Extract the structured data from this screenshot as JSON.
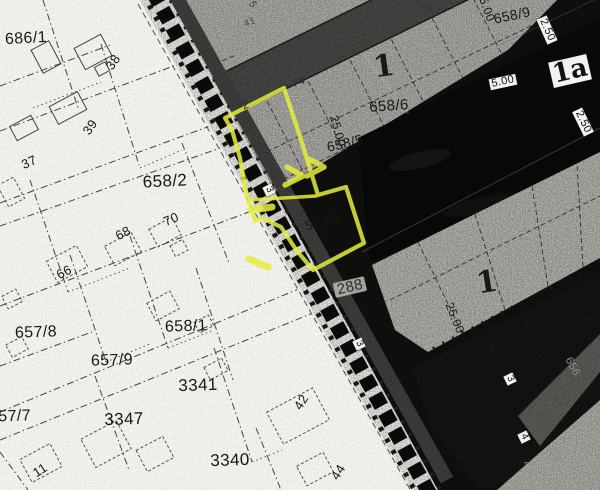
{
  "map": {
    "highlight_color": "#e6ed3a",
    "labels": [
      {
        "id": "parcel-686-1",
        "text": "686/1",
        "x": 26,
        "y": 39,
        "rot": -3,
        "size": 16
      },
      {
        "id": "house-38",
        "text": "38",
        "x": 113,
        "y": 62,
        "rot": -55,
        "size": 13
      },
      {
        "id": "house-39",
        "text": "39",
        "x": 90,
        "y": 127,
        "rot": -55,
        "size": 13
      },
      {
        "id": "house-37",
        "text": "37",
        "x": 29,
        "y": 162,
        "rot": -24,
        "size": 13
      },
      {
        "id": "parcel-658-2",
        "text": "658/2",
        "x": 165,
        "y": 181,
        "rot": -3,
        "size": 17
      },
      {
        "id": "house-70",
        "text": "70",
        "x": 171,
        "y": 219,
        "rot": -24,
        "size": 13
      },
      {
        "id": "house-68",
        "text": "68",
        "x": 123,
        "y": 233,
        "rot": -28,
        "size": 13
      },
      {
        "id": "house-66",
        "text": "66",
        "x": 64,
        "y": 272,
        "rot": -28,
        "size": 13
      },
      {
        "id": "parcel-657-8",
        "text": "657/8",
        "x": 36,
        "y": 333,
        "rot": -2,
        "size": 16
      },
      {
        "id": "parcel-658-1",
        "text": "658/1",
        "x": 186,
        "y": 327,
        "rot": -2,
        "size": 16
      },
      {
        "id": "parcel-657-9",
        "text": "657/9",
        "x": 112,
        "y": 361,
        "rot": -2,
        "size": 16
      },
      {
        "id": "parcel-3341",
        "text": "3341",
        "x": 198,
        "y": 385,
        "rot": -2,
        "size": 17
      },
      {
        "id": "parcel-657-7",
        "text": "657/7",
        "x": 10,
        "y": 417,
        "rot": -2,
        "size": 16
      },
      {
        "id": "parcel-3347",
        "text": "3347",
        "x": 124,
        "y": 419,
        "rot": -2,
        "size": 17
      },
      {
        "id": "house-42",
        "text": "42",
        "x": 301,
        "y": 402,
        "rot": -58,
        "size": 13
      },
      {
        "id": "parcel-3340",
        "text": "3340",
        "x": 230,
        "y": 460,
        "rot": -2,
        "size": 17
      },
      {
        "id": "house-44",
        "text": "44",
        "x": 338,
        "y": 472,
        "rot": -58,
        "size": 13
      },
      {
        "id": "house-11",
        "text": "11",
        "x": 40,
        "y": 470,
        "rot": -33,
        "size": 13
      },
      {
        "id": "block-1-upper",
        "text": "1",
        "x": 384,
        "y": 67,
        "rot": -8,
        "size": 30,
        "cls": "big"
      },
      {
        "id": "parcel-658-6",
        "text": "658/6",
        "x": 389,
        "y": 106,
        "rot": -4,
        "size": 15
      },
      {
        "id": "dim-25-00-upper",
        "text": "25.00",
        "x": 338,
        "y": 131,
        "rot": 74,
        "size": 12
      },
      {
        "id": "parcel-658-5",
        "text": "658/5",
        "x": 345,
        "y": 143,
        "rot": -13,
        "size": 14
      },
      {
        "id": "parcel-658-9",
        "text": "658/9",
        "x": 512,
        "y": 15,
        "rot": -12,
        "size": 14
      },
      {
        "id": "dim-25-00-top",
        "text": "25.00",
        "x": 486,
        "y": 6,
        "rot": 70,
        "size": 12
      },
      {
        "id": "house-78",
        "text": "78",
        "x": 427,
        "y": 9,
        "rot": -24,
        "size": 11,
        "color": "#333330"
      },
      {
        "id": "dim-2-50-a",
        "text": "2.50",
        "x": 547,
        "y": 30,
        "rot": 66,
        "size": 11,
        "cls": "box"
      },
      {
        "id": "block-1a",
        "text": "1a",
        "x": 570,
        "y": 71,
        "rot": -13,
        "size": 26,
        "cls": "big box"
      },
      {
        "id": "dim-5-00",
        "text": "5.00",
        "x": 503,
        "y": 82,
        "rot": -12,
        "size": 11,
        "cls": "box"
      },
      {
        "id": "dim-2-50-b",
        "text": "2.50",
        "x": 583,
        "y": 122,
        "rot": 64,
        "size": 11,
        "cls": "box"
      },
      {
        "id": "dim-52-50",
        "text": "52.50",
        "x": 322,
        "y": 222,
        "rot": -14,
        "size": 13
      },
      {
        "id": "mark-plus",
        "text": "+",
        "x": 326,
        "y": 234,
        "rot": 0,
        "size": 10
      },
      {
        "id": "parcel-288",
        "text": "288",
        "x": 350,
        "y": 287,
        "rot": -13,
        "size": 15,
        "cls": "smudge"
      },
      {
        "id": "block-1-lower",
        "text": "1",
        "x": 487,
        "y": 283,
        "rot": -9,
        "size": 30,
        "cls": "big"
      },
      {
        "id": "dim-25-00-lower",
        "text": "25.00",
        "x": 455,
        "y": 318,
        "rot": 68,
        "size": 12
      },
      {
        "id": "tick-5",
        "text": "5",
        "x": 527,
        "y": 322,
        "rot": -20,
        "size": 11
      },
      {
        "id": "tick-3",
        "text": "3",
        "x": 492,
        "y": 348,
        "rot": -22,
        "size": 10,
        "color": "#222220"
      },
      {
        "id": "marker-3-rail-upper",
        "text": "3",
        "x": 269,
        "y": 190,
        "rot": 64,
        "size": 10,
        "cls": "box"
      },
      {
        "id": "marker-3-rail-mid",
        "text": "3",
        "x": 359,
        "y": 344,
        "rot": 64,
        "size": 10,
        "cls": "box"
      },
      {
        "id": "marker-3-east",
        "text": "3",
        "x": 510,
        "y": 379,
        "rot": 64,
        "size": 10,
        "cls": "box"
      },
      {
        "id": "marker-4",
        "text": "4",
        "x": 524,
        "y": 437,
        "rot": 64,
        "size": 10,
        "cls": "box"
      },
      {
        "id": "ghost-656",
        "text": "656",
        "x": 572,
        "y": 367,
        "rot": 62,
        "size": 11,
        "color": "#8f8f8c"
      },
      {
        "id": "ghost-320",
        "text": "320",
        "x": 555,
        "y": 455,
        "rot": 62,
        "size": 10,
        "color": "#8a8a86"
      },
      {
        "id": "ghost-458",
        "text": "458",
        "x": 529,
        "y": 470,
        "rot": 62,
        "size": 10,
        "color": "#979792"
      },
      {
        "id": "tick-5-top",
        "text": "5",
        "x": 252,
        "y": 5,
        "rot": 60,
        "size": 10,
        "color": "#44443f"
      },
      {
        "id": "house-41",
        "text": "41",
        "x": 250,
        "y": 23,
        "rot": -18,
        "size": 10,
        "color": "#4a4a45"
      },
      {
        "id": "house-72",
        "text": "2",
        "x": 246,
        "y": 106,
        "rot": -18,
        "size": 11,
        "color": "#2c2c28"
      },
      {
        "id": "house-74",
        "text": "74",
        "x": 299,
        "y": 83,
        "rot": -18,
        "size": 11,
        "color": "#2c2c28"
      },
      {
        "id": "house-76",
        "text": "76",
        "x": 362,
        "y": 45,
        "rot": -24,
        "size": 10,
        "color": "#3a3a36"
      }
    ]
  }
}
